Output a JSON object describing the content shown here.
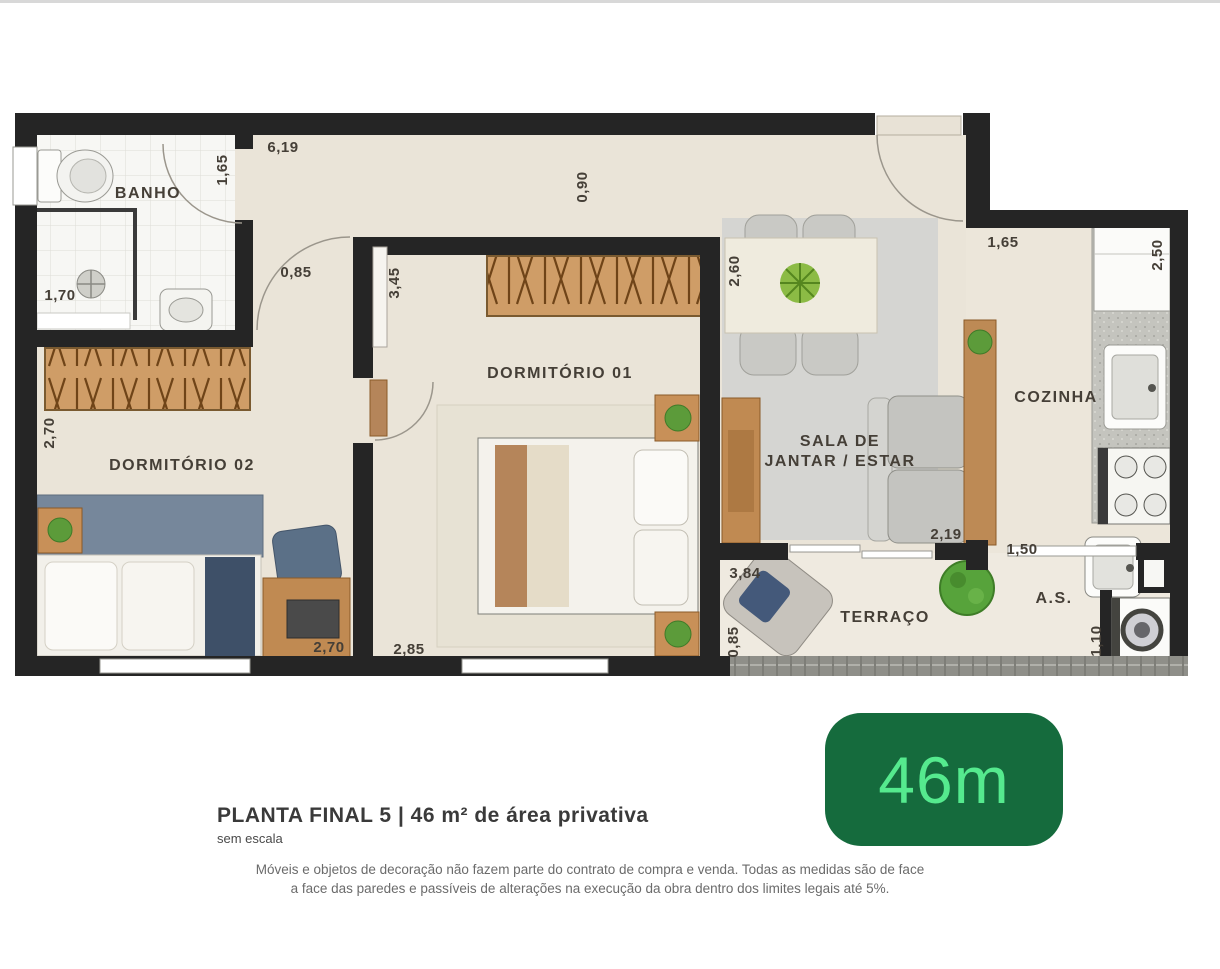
{
  "plan": {
    "rooms": {
      "banho": "BANHO",
      "dormitorio02": "DORMITÓRIO 02",
      "dormitorio01": "DORMITÓRIO 01",
      "sala_line1": "SALA DE",
      "sala_line2": "JANTAR / ESTAR",
      "cozinha": "COZINHA",
      "terraco": "TERRAÇO",
      "area_servico": "A.S."
    },
    "dimensions": {
      "top_width": "6,19",
      "banho_depth": "1,65",
      "entry_width": "0,90",
      "dining_width": "2,60",
      "cozinha_top": "1,65",
      "cozinha_depth": "2,50",
      "hall_width": "0,85",
      "dorm01_depth": "3,45",
      "banho_width": "1,70",
      "dorm02_depth": "2,70",
      "dorm02_width": "2,70",
      "dorm01_width": "2,85",
      "sala_width": "2,19",
      "as_opening": "1,50",
      "terraco_width": "3,84",
      "terraco_depth": "0,85",
      "as_width": "1,10"
    }
  },
  "footer": {
    "title": "PLANTA FINAL 5 | 46 m² de área privativa",
    "scale_note": "sem escala",
    "disclaimer_line1": "Móveis e objetos de decoração não fazem parte do contrato de compra e venda. Todas as medidas são de face",
    "disclaimer_line2": "a face das paredes e passíveis de alterações na execução da obra dentro dos limites legais até 5%."
  },
  "badge": {
    "area_label": "46m"
  },
  "colors": {
    "wall": "#252525",
    "floor": "#EAE4D8",
    "badge_bg": "#156B3D",
    "badge_text": "#55EA8E"
  }
}
